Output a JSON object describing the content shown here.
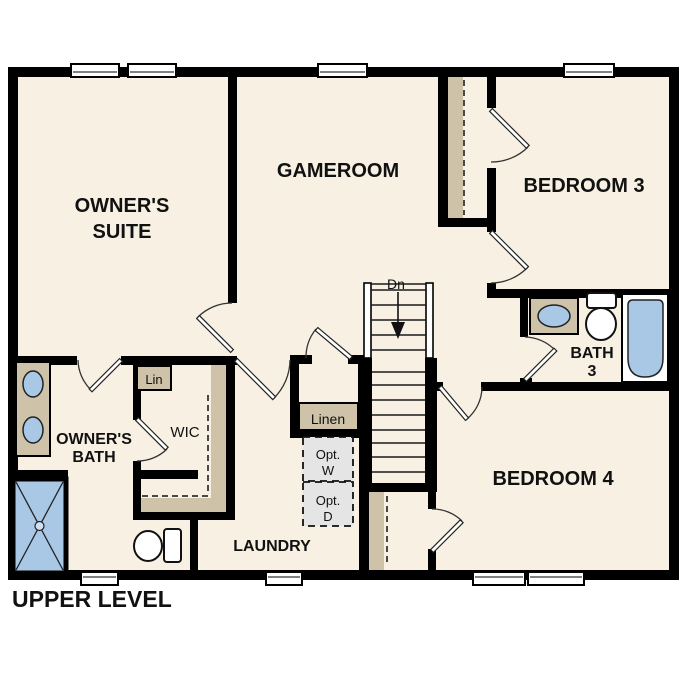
{
  "title": "UPPER LEVEL",
  "palette": {
    "background": "#FFFFFF",
    "floor": "#F7F0E3",
    "wall": "#000000",
    "closet_shelf": "#CEC2A9",
    "plumbing_blue": "#A9C8E6",
    "optional_gray": "#E5E5E5",
    "text": "#111111"
  },
  "rooms": {
    "owners_suite": {
      "line1": "OWNER'S",
      "line2": "SUITE"
    },
    "gameroom": {
      "label": "GAMEROOM"
    },
    "bedroom3": {
      "label": "BEDROOM 3"
    },
    "bedroom4": {
      "label": "BEDROOM 4"
    },
    "owners_bath": {
      "line1": "OWNER'S",
      "line2": "BATH"
    },
    "bath3": {
      "line1": "BATH",
      "line2": "3"
    },
    "laundry": {
      "label": "LAUNDRY"
    },
    "wic": {
      "label": "WIC"
    }
  },
  "closets": {
    "lin": {
      "label": "Lin"
    },
    "linen": {
      "label": "Linen"
    }
  },
  "appliances": {
    "washer": {
      "line1": "Opt.",
      "line2": "W"
    },
    "dryer": {
      "line1": "Opt.",
      "line2": "D"
    }
  },
  "stairs": {
    "label": "Dn"
  }
}
